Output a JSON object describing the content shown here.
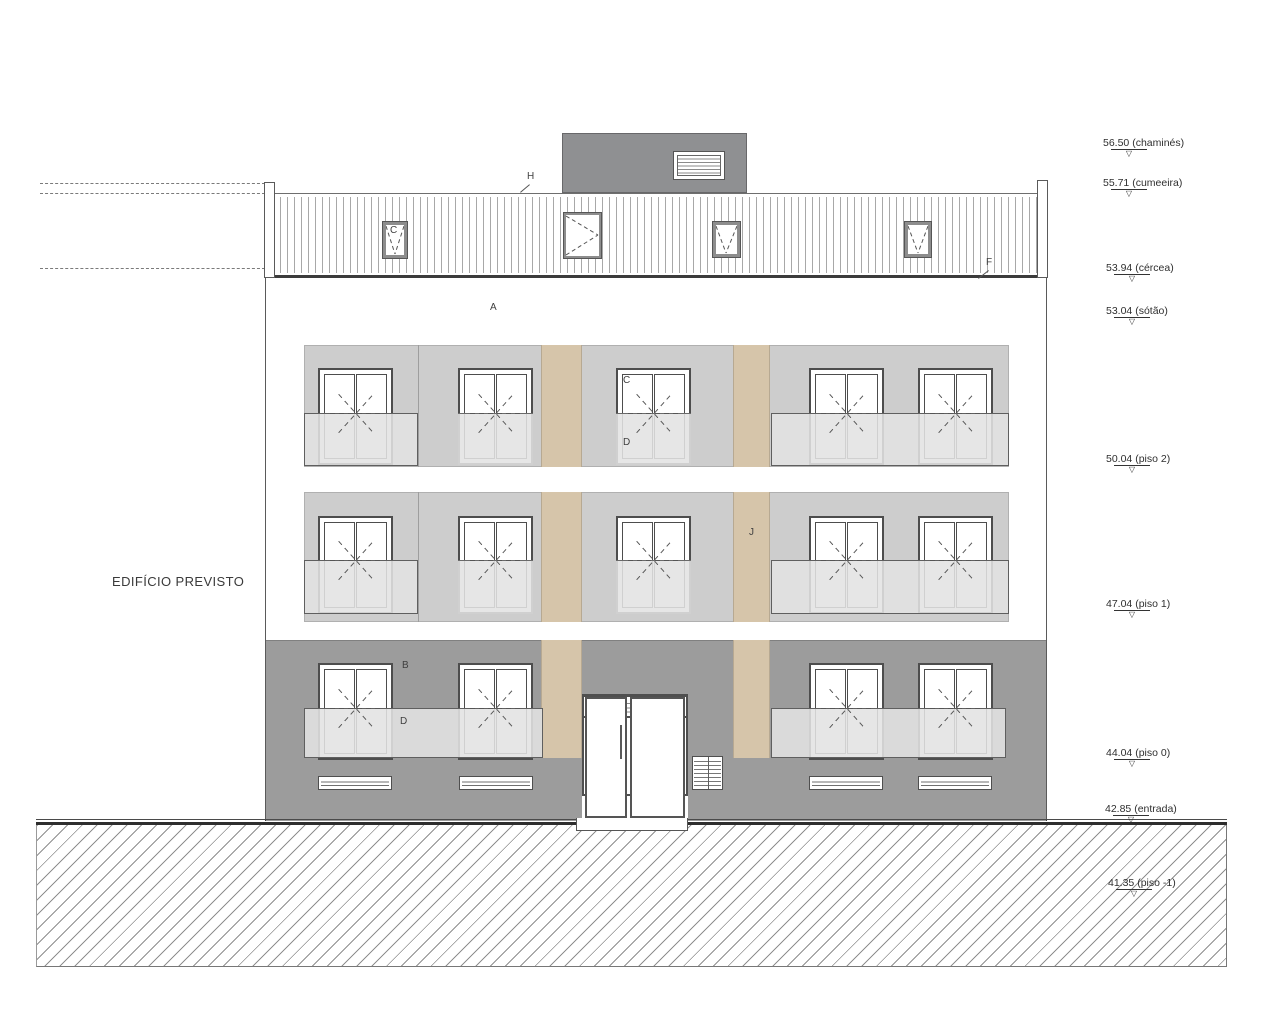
{
  "drawing": {
    "title": "EDIFÍCIO PREVISTO",
    "type_note": "front elevation of planned building"
  },
  "levels": [
    {
      "label": "56.50 (chaminés)"
    },
    {
      "label": "55.71 (cumeeira)"
    },
    {
      "label": "53.94 (cércea)"
    },
    {
      "label": "53.04 (sótão)"
    },
    {
      "label": "50.04 (piso 2)"
    },
    {
      "label": "47.04 (piso 1)"
    },
    {
      "label": "44.04 (piso 0)"
    },
    {
      "label": "42.85 (entrada)"
    },
    {
      "label": "41.35 (piso -1)"
    }
  ],
  "letters": {
    "roof_ridge": "H",
    "roof_eave": "F",
    "attic": "A",
    "skylight": "C",
    "p2_window_top": "C",
    "p2_window_bottom": "D",
    "p1_pilaster": "J",
    "p0_wall": "B",
    "p0_guard": "D",
    "entrance_transom": "G"
  },
  "colors": {
    "upper_wall": "#cdcdcd",
    "ground_wall": "#9c9c9c",
    "chimney": "#8f9092",
    "accent_beige": "#d6c5aa",
    "guard_glass": "#e2e2e2",
    "line": "#4d4d4d"
  }
}
